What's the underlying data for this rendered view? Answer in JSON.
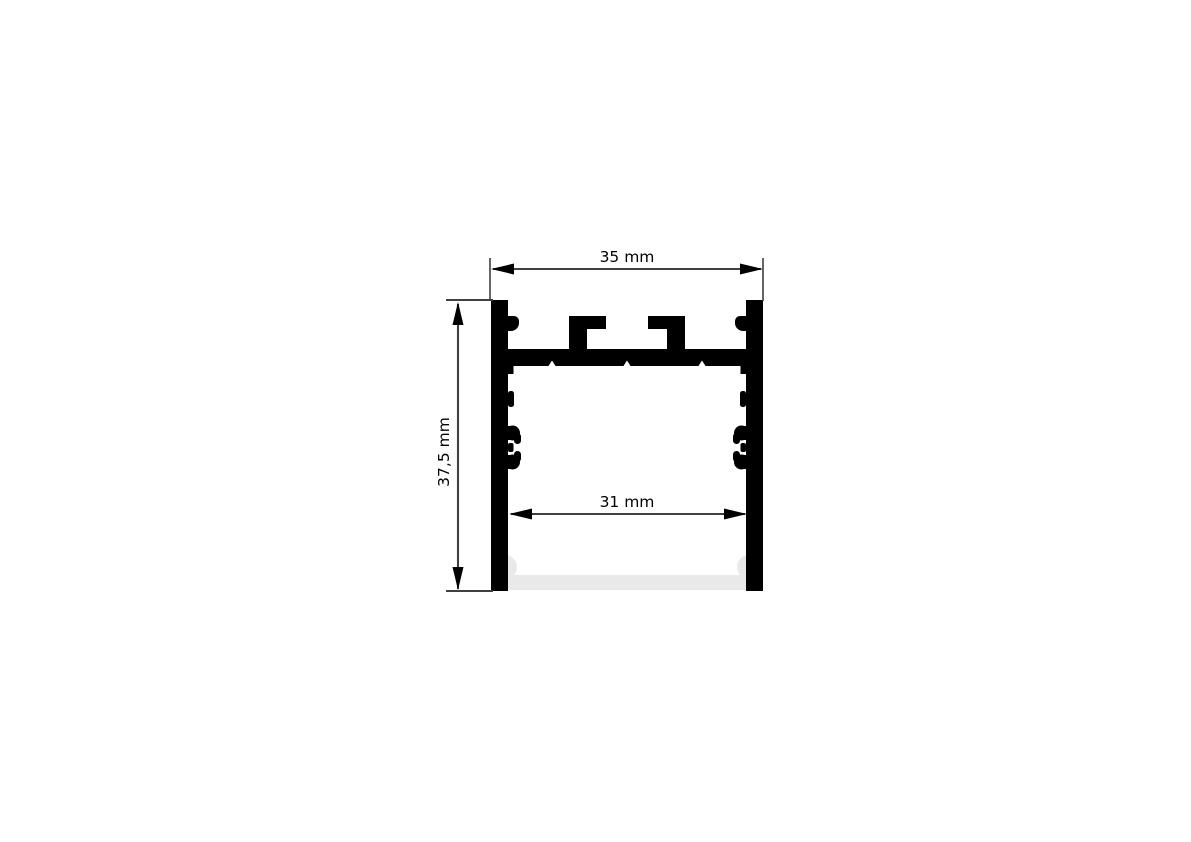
{
  "page": {
    "background_color": "#ffffff"
  },
  "drawing": {
    "type": "technical-cross-section",
    "subject": "aluminium-led-profile",
    "colors": {
      "profile_fill": "#000000",
      "diffuser_fill": "#e9e9e9",
      "dimension_line_color": "#404040",
      "arrow_color": "#000000"
    },
    "dimensions": {
      "outer_width_label": "35 mm",
      "height_label": "37,5 mm",
      "inner_width_label": "31 mm"
    }
  }
}
